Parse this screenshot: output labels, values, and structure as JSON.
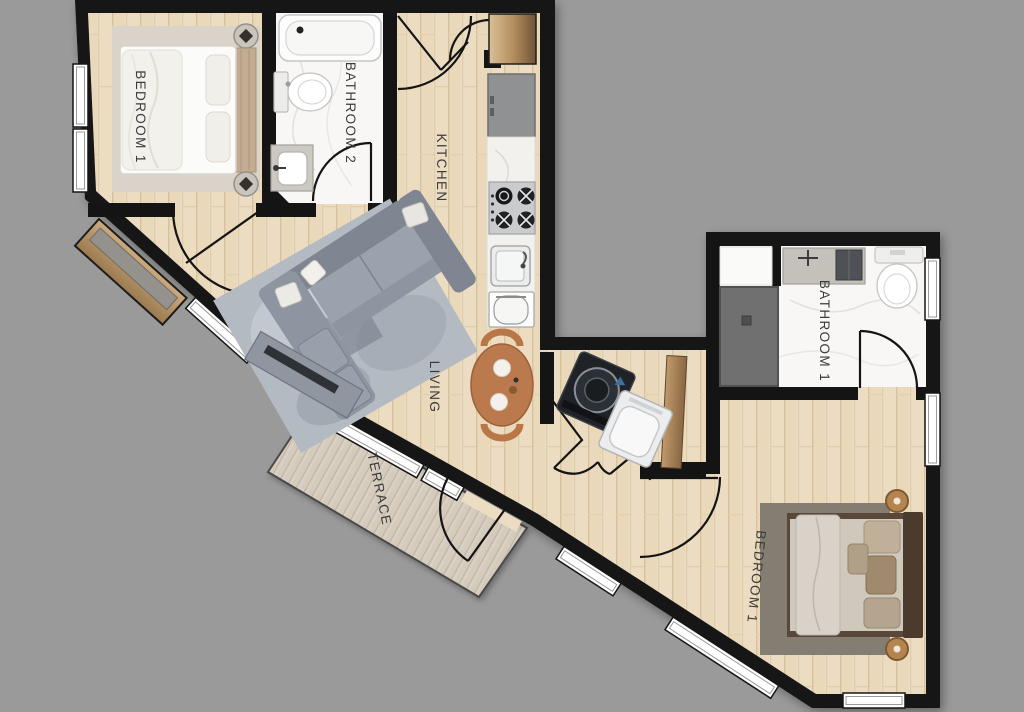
{
  "plan": {
    "type": "apartment-floor-plan",
    "colors": {
      "background": "#9a9a9a",
      "wall": "#141414",
      "wood_floor": "#ecdcc1",
      "terrace_deck": "#d9d0c3",
      "marble": "#f8f7f5",
      "shower": "#707070",
      "sofa": "#98a0ac",
      "living_rug": "#b3bac2",
      "dining_table": "#bb7a4d",
      "label": "#3b3b3b"
    },
    "rooms": {
      "bedroom_1_left": {
        "label": "BEDROOM 1"
      },
      "bathroom_2": {
        "label": "BATHROOM 2"
      },
      "kitchen": {
        "label": "KITCHEN"
      },
      "living": {
        "label": "LIVING"
      },
      "terrace": {
        "label": "TERRACE"
      },
      "bathroom_1": {
        "label": "BATHROOM 1"
      },
      "bedroom_1_right": {
        "label": "BEDROOM 1"
      }
    },
    "fixtures": [
      "double-bed",
      "nightstand",
      "table-lamp",
      "area-rug",
      "bathtub",
      "toilet",
      "vanity-sink",
      "entry-closet",
      "pantry-closet",
      "refrigerator",
      "gas-stove",
      "kitchen-sink",
      "dishwasher",
      "sectional-sofa",
      "throw-pillow",
      "tv-console",
      "dining-table",
      "dining-chair",
      "washing-machine",
      "dryer",
      "walk-in-shower",
      "shower-bench",
      "bathroom-vanity",
      "window",
      "door-swing"
    ]
  }
}
